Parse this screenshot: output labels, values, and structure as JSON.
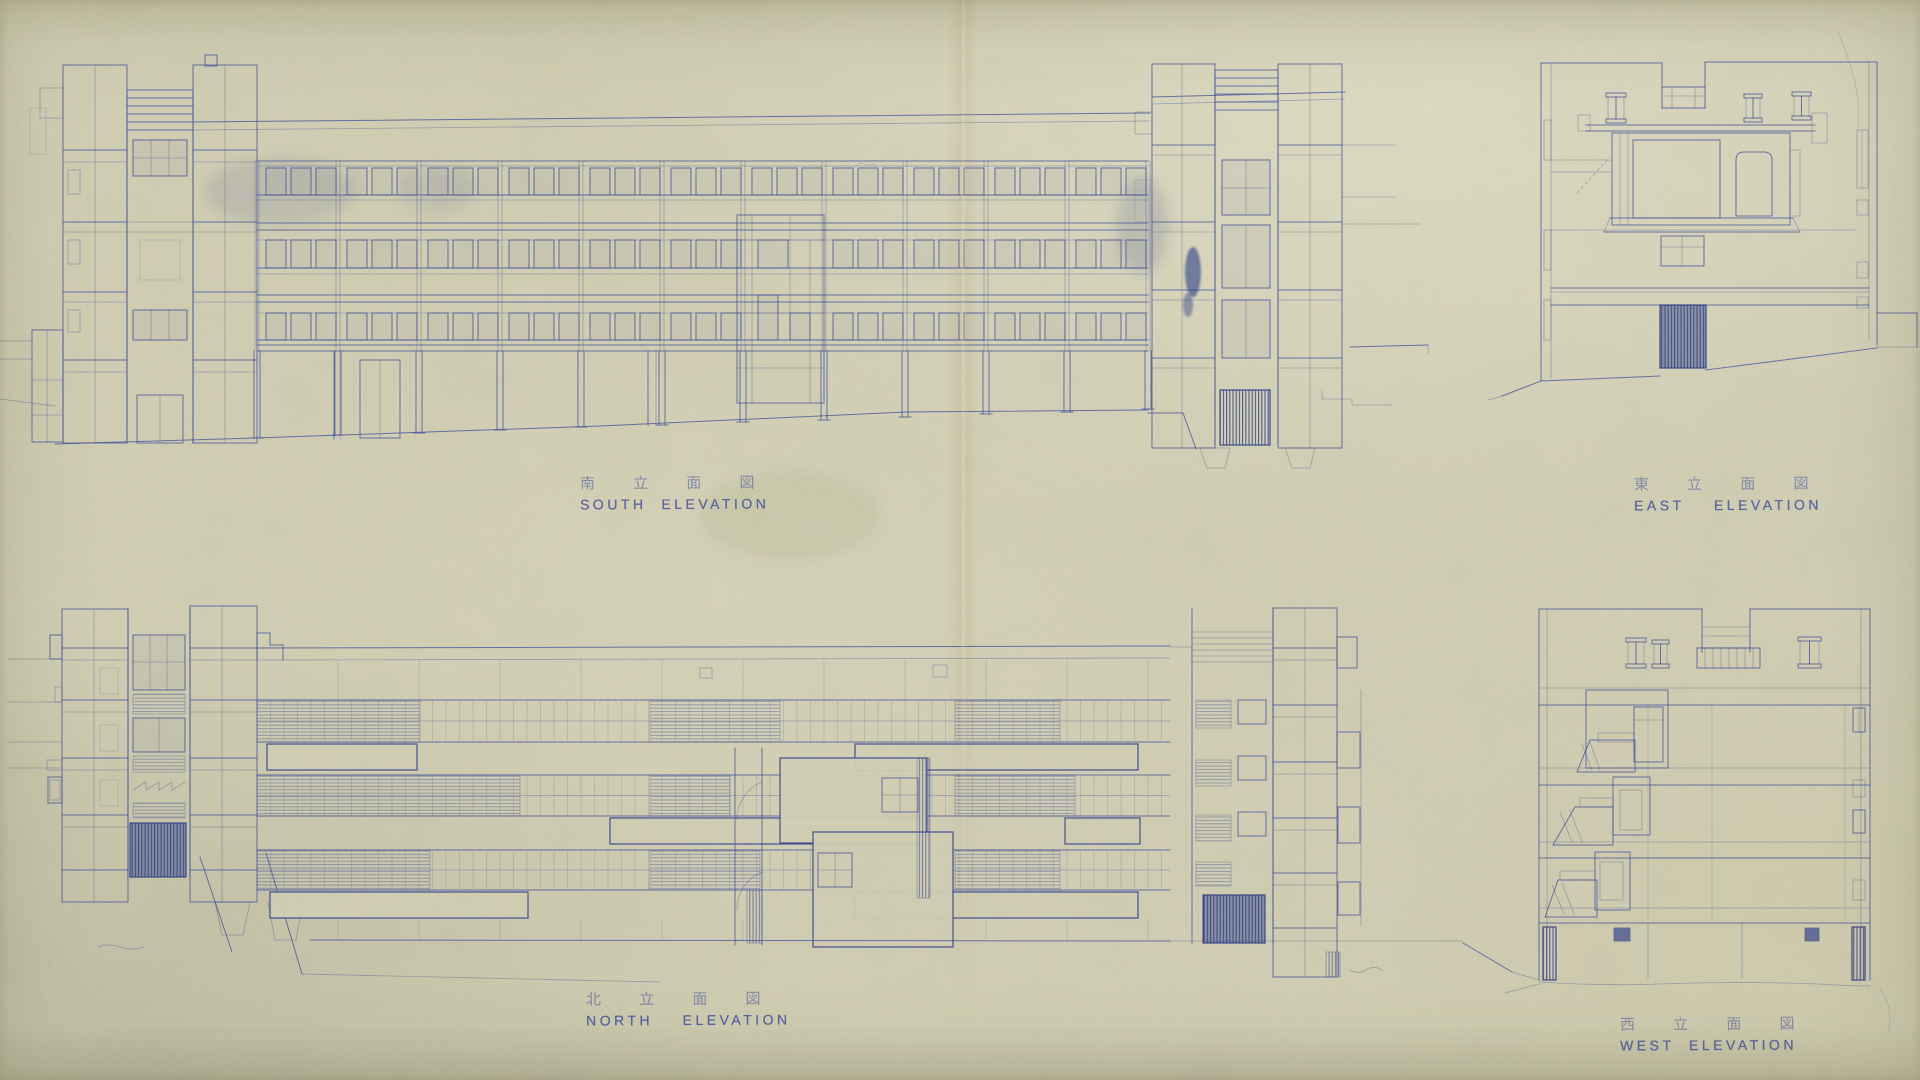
{
  "sheet": {
    "type": "architectural elevation blueprint",
    "views": [
      "south",
      "east",
      "north",
      "west"
    ],
    "paper_color": "#d4d1b6",
    "ink_color": "#41519b"
  },
  "elevations": {
    "south": {
      "label_ja": "南 立 面 図",
      "label_en": "SOUTH  ELEVATION"
    },
    "east": {
      "label_ja": "東 立 面 図",
      "label_en": "EAST    ELEVATION"
    },
    "north": {
      "label_ja": "北 立 面 図",
      "label_en": "NORTH    ELEVATION"
    },
    "west": {
      "label_ja": "西 立 面 図",
      "label_en": "WEST  ELEVATION"
    }
  }
}
